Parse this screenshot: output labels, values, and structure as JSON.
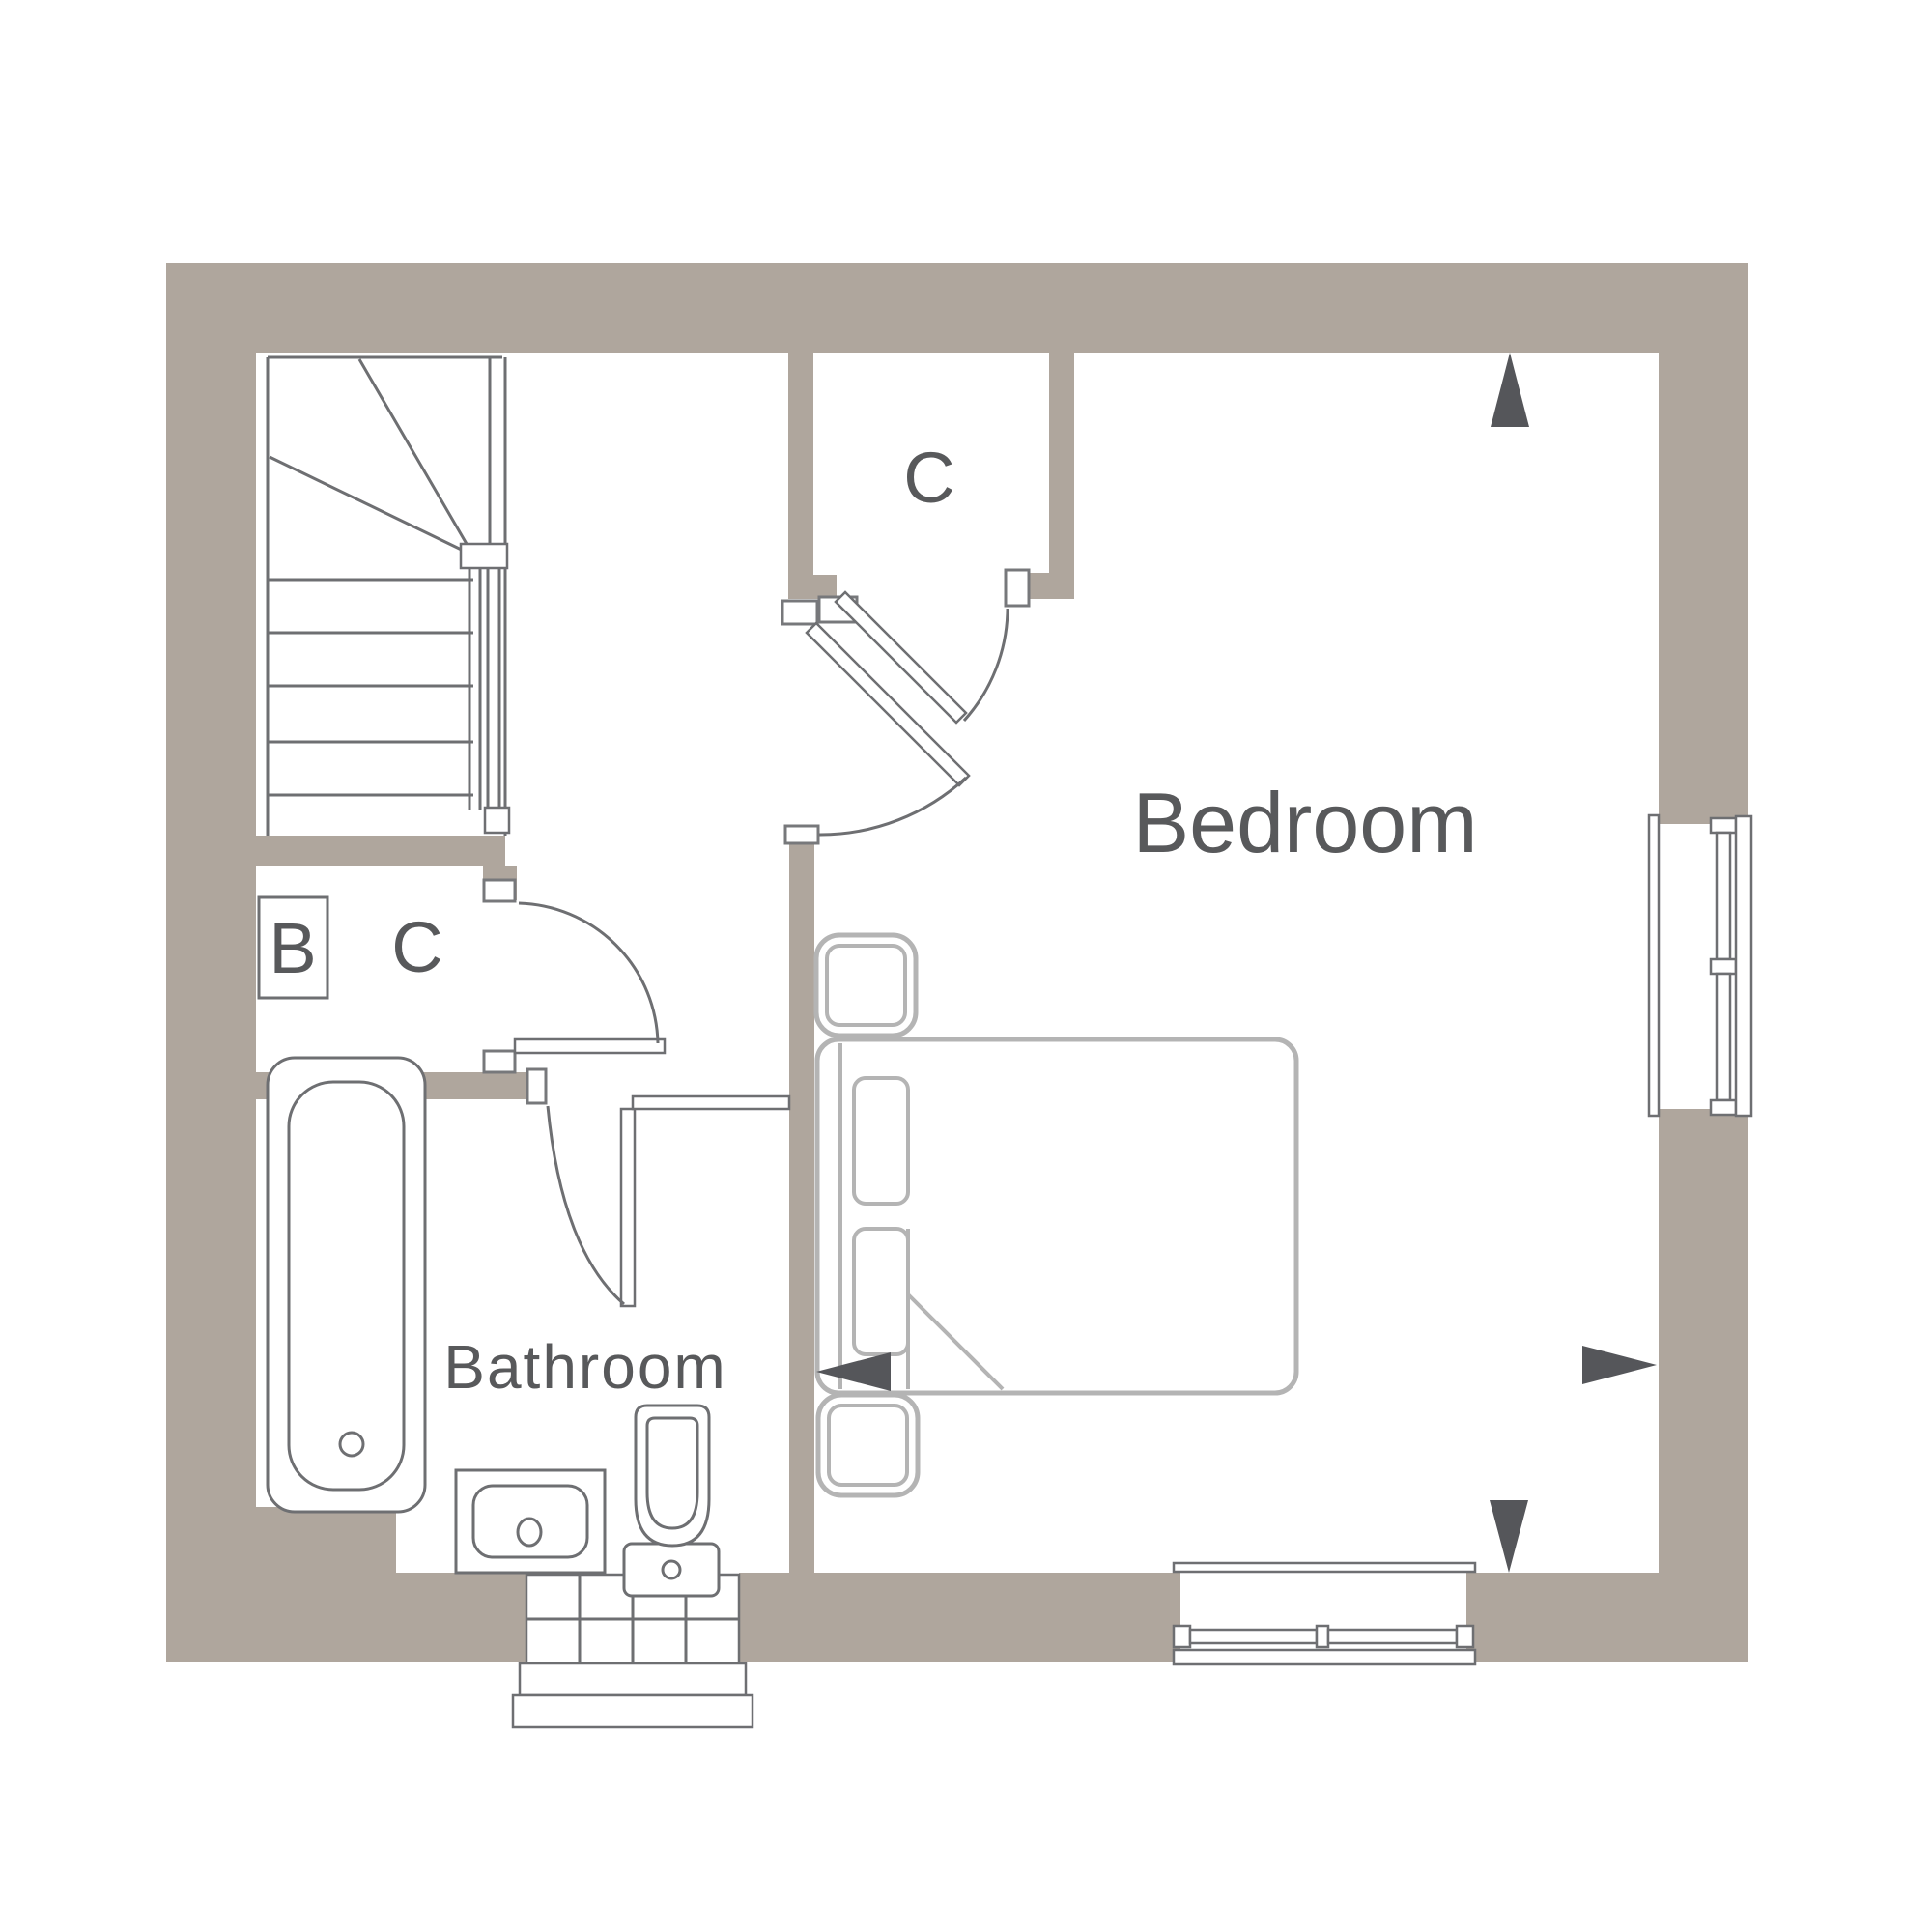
{
  "plan": {
    "type": "floor-plan",
    "rooms": [
      {
        "name": "Bedroom"
      },
      {
        "name": "Bathroom"
      },
      {
        "name": "Closet C (top)"
      },
      {
        "name": "Closet C (landing / under-stairs)"
      },
      {
        "name": "Boiler cupboard B"
      }
    ]
  },
  "labels": {
    "bedroom": "Bedroom",
    "bathroom": "Bathroom",
    "closet_top": "C",
    "closet_hall": "C",
    "boiler": "B"
  },
  "colors": {
    "wall": "#afa69d",
    "line": "#6e6f72",
    "furniture": "#b4b4b4",
    "jamb": "#77787b",
    "text": "#58595b",
    "arrow": "#55565a",
    "background": "#ffffff"
  }
}
